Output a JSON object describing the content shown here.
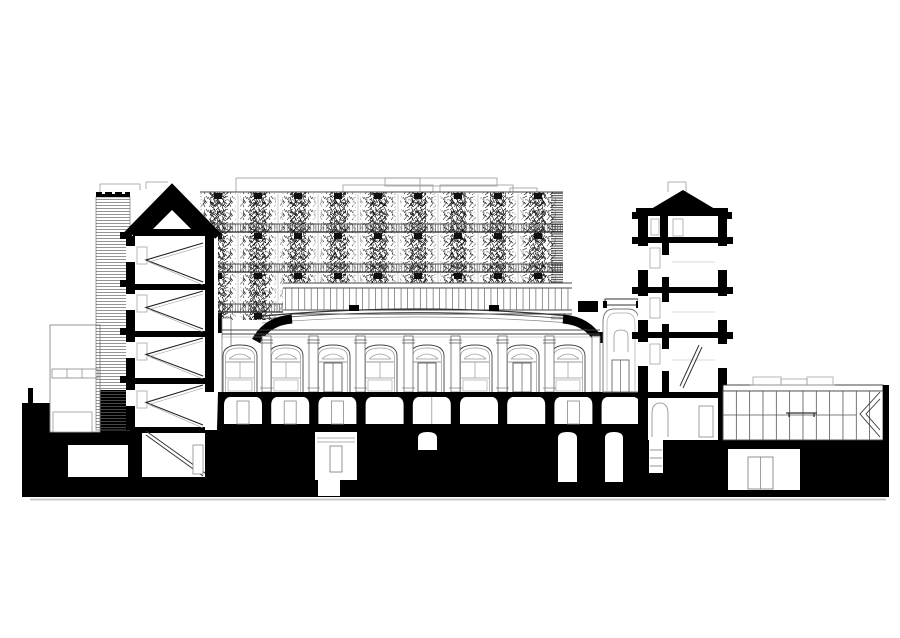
{
  "meta": {
    "description": "black-and-white architectural cross-section drawing of a building complex",
    "background": "#ffffff",
    "ink": "#000000",
    "dark_line": "#333333",
    "mid_line": "#666666",
    "light_line": "#999999",
    "faint_line": "#bbbbbb",
    "shadow": "#c9c9c9"
  },
  "geometry": {
    "ground": {
      "rects": [
        [
          22,
          403,
          74,
          94
        ],
        [
          28,
          388,
          5,
          15
        ],
        [
          96,
          390,
          790,
          107
        ]
      ],
      "shadow": [
        30,
        498.5,
        856,
        2
      ]
    },
    "vaults": {
      "x0": 224,
      "pitch": 47.2,
      "count": 9,
      "w": 38,
      "top": 396,
      "bottom": 424,
      "doors": [
        0,
        1,
        2,
        7
      ],
      "center_line": [
        4
      ]
    },
    "rooms": [
      {
        "x": 68,
        "y": 445,
        "w": 60,
        "h": 32
      },
      {
        "x": 315,
        "y": 432,
        "w": 42,
        "h": 48,
        "door": [
          330,
          446,
          12,
          26
        ],
        "toplines": true,
        "sump": [
          318,
          480,
          22,
          16
        ]
      },
      {
        "x": 418,
        "y": 432,
        "w": 19,
        "h": 18,
        "arch": true
      },
      {
        "x": 558,
        "y": 432,
        "w": 19,
        "h": 50,
        "arch": true
      },
      {
        "x": 605,
        "y": 432,
        "w": 18,
        "h": 50,
        "arch": true
      },
      {
        "x": 649,
        "y": 440,
        "w": 14,
        "h": 33,
        "shaft": true
      },
      {
        "x": 728,
        "y": 449,
        "w": 72,
        "h": 41,
        "door": [
          748,
          457,
          25,
          32
        ],
        "double": true
      }
    ],
    "veg": {
      "x0": 203,
      "pitch": 40,
      "bays": 9,
      "cluster_w": 30,
      "rows": [
        {
          "y": 192,
          "h": 40
        },
        {
          "y": 232,
          "h": 40
        },
        {
          "y": 272,
          "h": 40
        }
      ],
      "extra_row": {
        "y": 312,
        "h": 13,
        "bays": 2
      },
      "right_edge": [
        551,
        192,
        12,
        130
      ],
      "band_lines": [
        232,
        272,
        312
      ],
      "light_lines": [
        224,
        264,
        304
      ],
      "top_line": 192,
      "span": [
        200,
        563
      ],
      "railings": [
        [
          202,
          224,
          361,
          8
        ],
        [
          202,
          264,
          361,
          8
        ],
        [
          202,
          304,
          81,
          8
        ]
      ],
      "parapets": [
        [
          236,
          178,
          184,
          14
        ],
        [
          385,
          178,
          112,
          8
        ],
        [
          343,
          185,
          90,
          7
        ],
        [
          440,
          185,
          73,
          7
        ],
        [
          510,
          188,
          27,
          4
        ]
      ]
    },
    "gridband": {
      "x": 283,
      "y": 283,
      "w": 289,
      "h": 33,
      "mullion_pitch": 6.42,
      "m_top": 288,
      "m_bot": 310,
      "lines": [
        283,
        288,
        310,
        314
      ]
    },
    "hall": {
      "left": 222,
      "right": 600,
      "floor": [
        213,
        392,
        435,
        5
      ],
      "cornices": [
        330,
        334,
        337
      ],
      "pilasters": [
        262,
        309,
        356,
        404,
        451,
        498,
        545
      ],
      "bays": [
        {
          "c": 240,
          "door": false
        },
        {
          "c": 286,
          "door": false
        },
        {
          "c": 333,
          "door": true
        },
        {
          "c": 380,
          "door": false
        },
        {
          "c": 427,
          "door": true
        },
        {
          "c": 475,
          "door": false
        },
        {
          "c": 522,
          "door": true
        },
        {
          "c": 568,
          "door": false
        }
      ],
      "roof_arcs": [
        [
          316,
          302
        ],
        [
          318,
          305
        ],
        [
          321,
          309
        ]
      ],
      "roof_span": [
        262,
        570
      ],
      "vents": [
        349,
        489
      ]
    },
    "ltower": {
      "slabs": [
        284,
        331,
        378,
        427
      ],
      "chevrons": [
        [
          236,
          284
        ],
        [
          284,
          331
        ],
        [
          331,
          378
        ],
        [
          378,
          427
        ]
      ],
      "windows": [
        246,
        294,
        342,
        390
      ],
      "bumps": [
        232,
        280,
        328,
        376
      ]
    },
    "rtower": {
      "slabs": [
        237,
        287,
        332
      ],
      "windows_left": [
        246,
        296,
        342
      ],
      "windows_right": [
        246,
        296,
        344
      ],
      "door_gaps": [
        255,
        302,
        349
      ],
      "room_lines": [
        262,
        312,
        360
      ],
      "bumps": [
        237,
        287,
        332
      ]
    },
    "pavilion": {
      "x": 723,
      "w": 160,
      "glaze_top": 391,
      "glaze_bot": 440,
      "mullions": 12,
      "pitch": 13.33,
      "transom": [
        723,
        415,
        856,
        415
      ],
      "equip": [
        [
          753,
          377,
          28,
          8
        ],
        [
          781,
          379,
          26,
          6
        ],
        [
          807,
          377,
          26,
          8
        ]
      ],
      "wall": [
        883,
        385,
        6,
        112
      ]
    }
  }
}
